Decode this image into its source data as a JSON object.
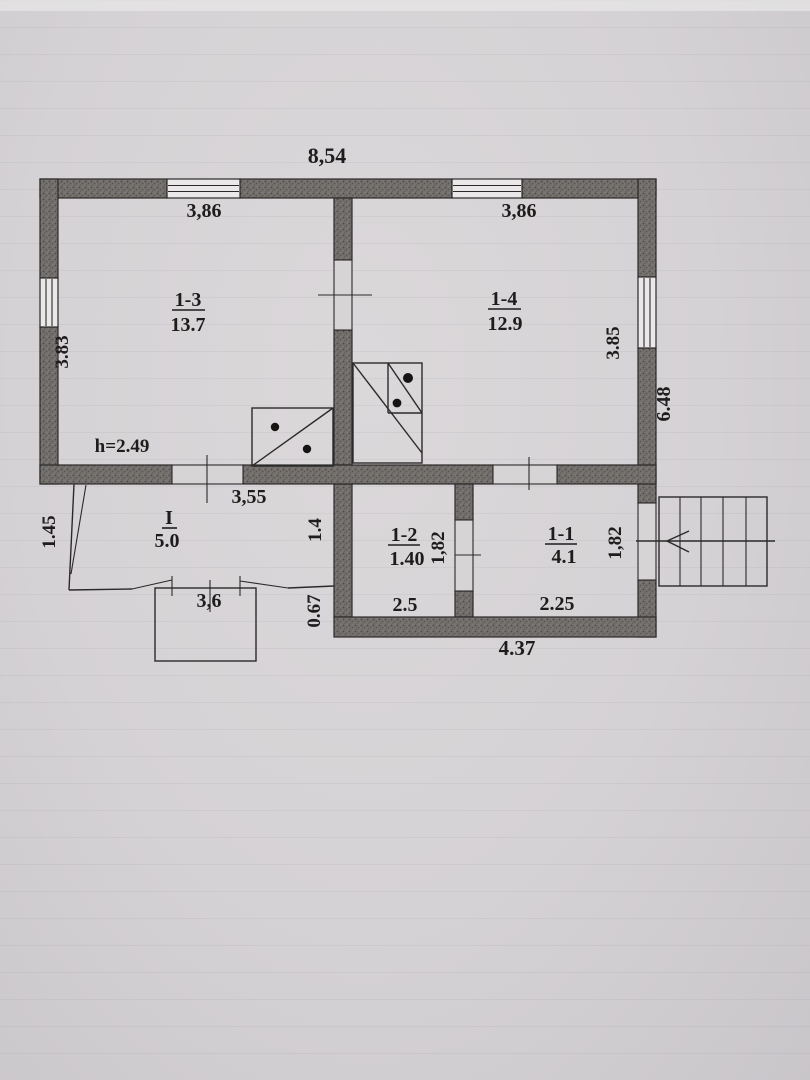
{
  "plan": {
    "overall": {
      "top_width": "8,54",
      "right_total_height": "6.48",
      "bottom_width": "4.37"
    },
    "rooms": {
      "r13": {
        "number": "1-3",
        "area": "13.7",
        "top_dim": "3,86",
        "left_dim": "3.83",
        "ceiling_height": "h=2.49"
      },
      "r14": {
        "number": "1-4",
        "area": "12.9",
        "top_dim": "3,86",
        "right_dim": "3.85"
      },
      "r12": {
        "number": "1-2",
        "area": "1.40",
        "depth_dim": "1,82",
        "bottom_dim": "2.5"
      },
      "r11": {
        "number": "1-1",
        "area": "4.1",
        "depth_dim": "1,82",
        "bottom_dim": "2.25"
      },
      "porch": {
        "number": "I",
        "area": "5.0",
        "top_dim": "3,55",
        "left_dim": "1.45",
        "right_dim": "1.4",
        "bottom_dim": "3,6",
        "offset_dim": "0.67"
      }
    }
  }
}
